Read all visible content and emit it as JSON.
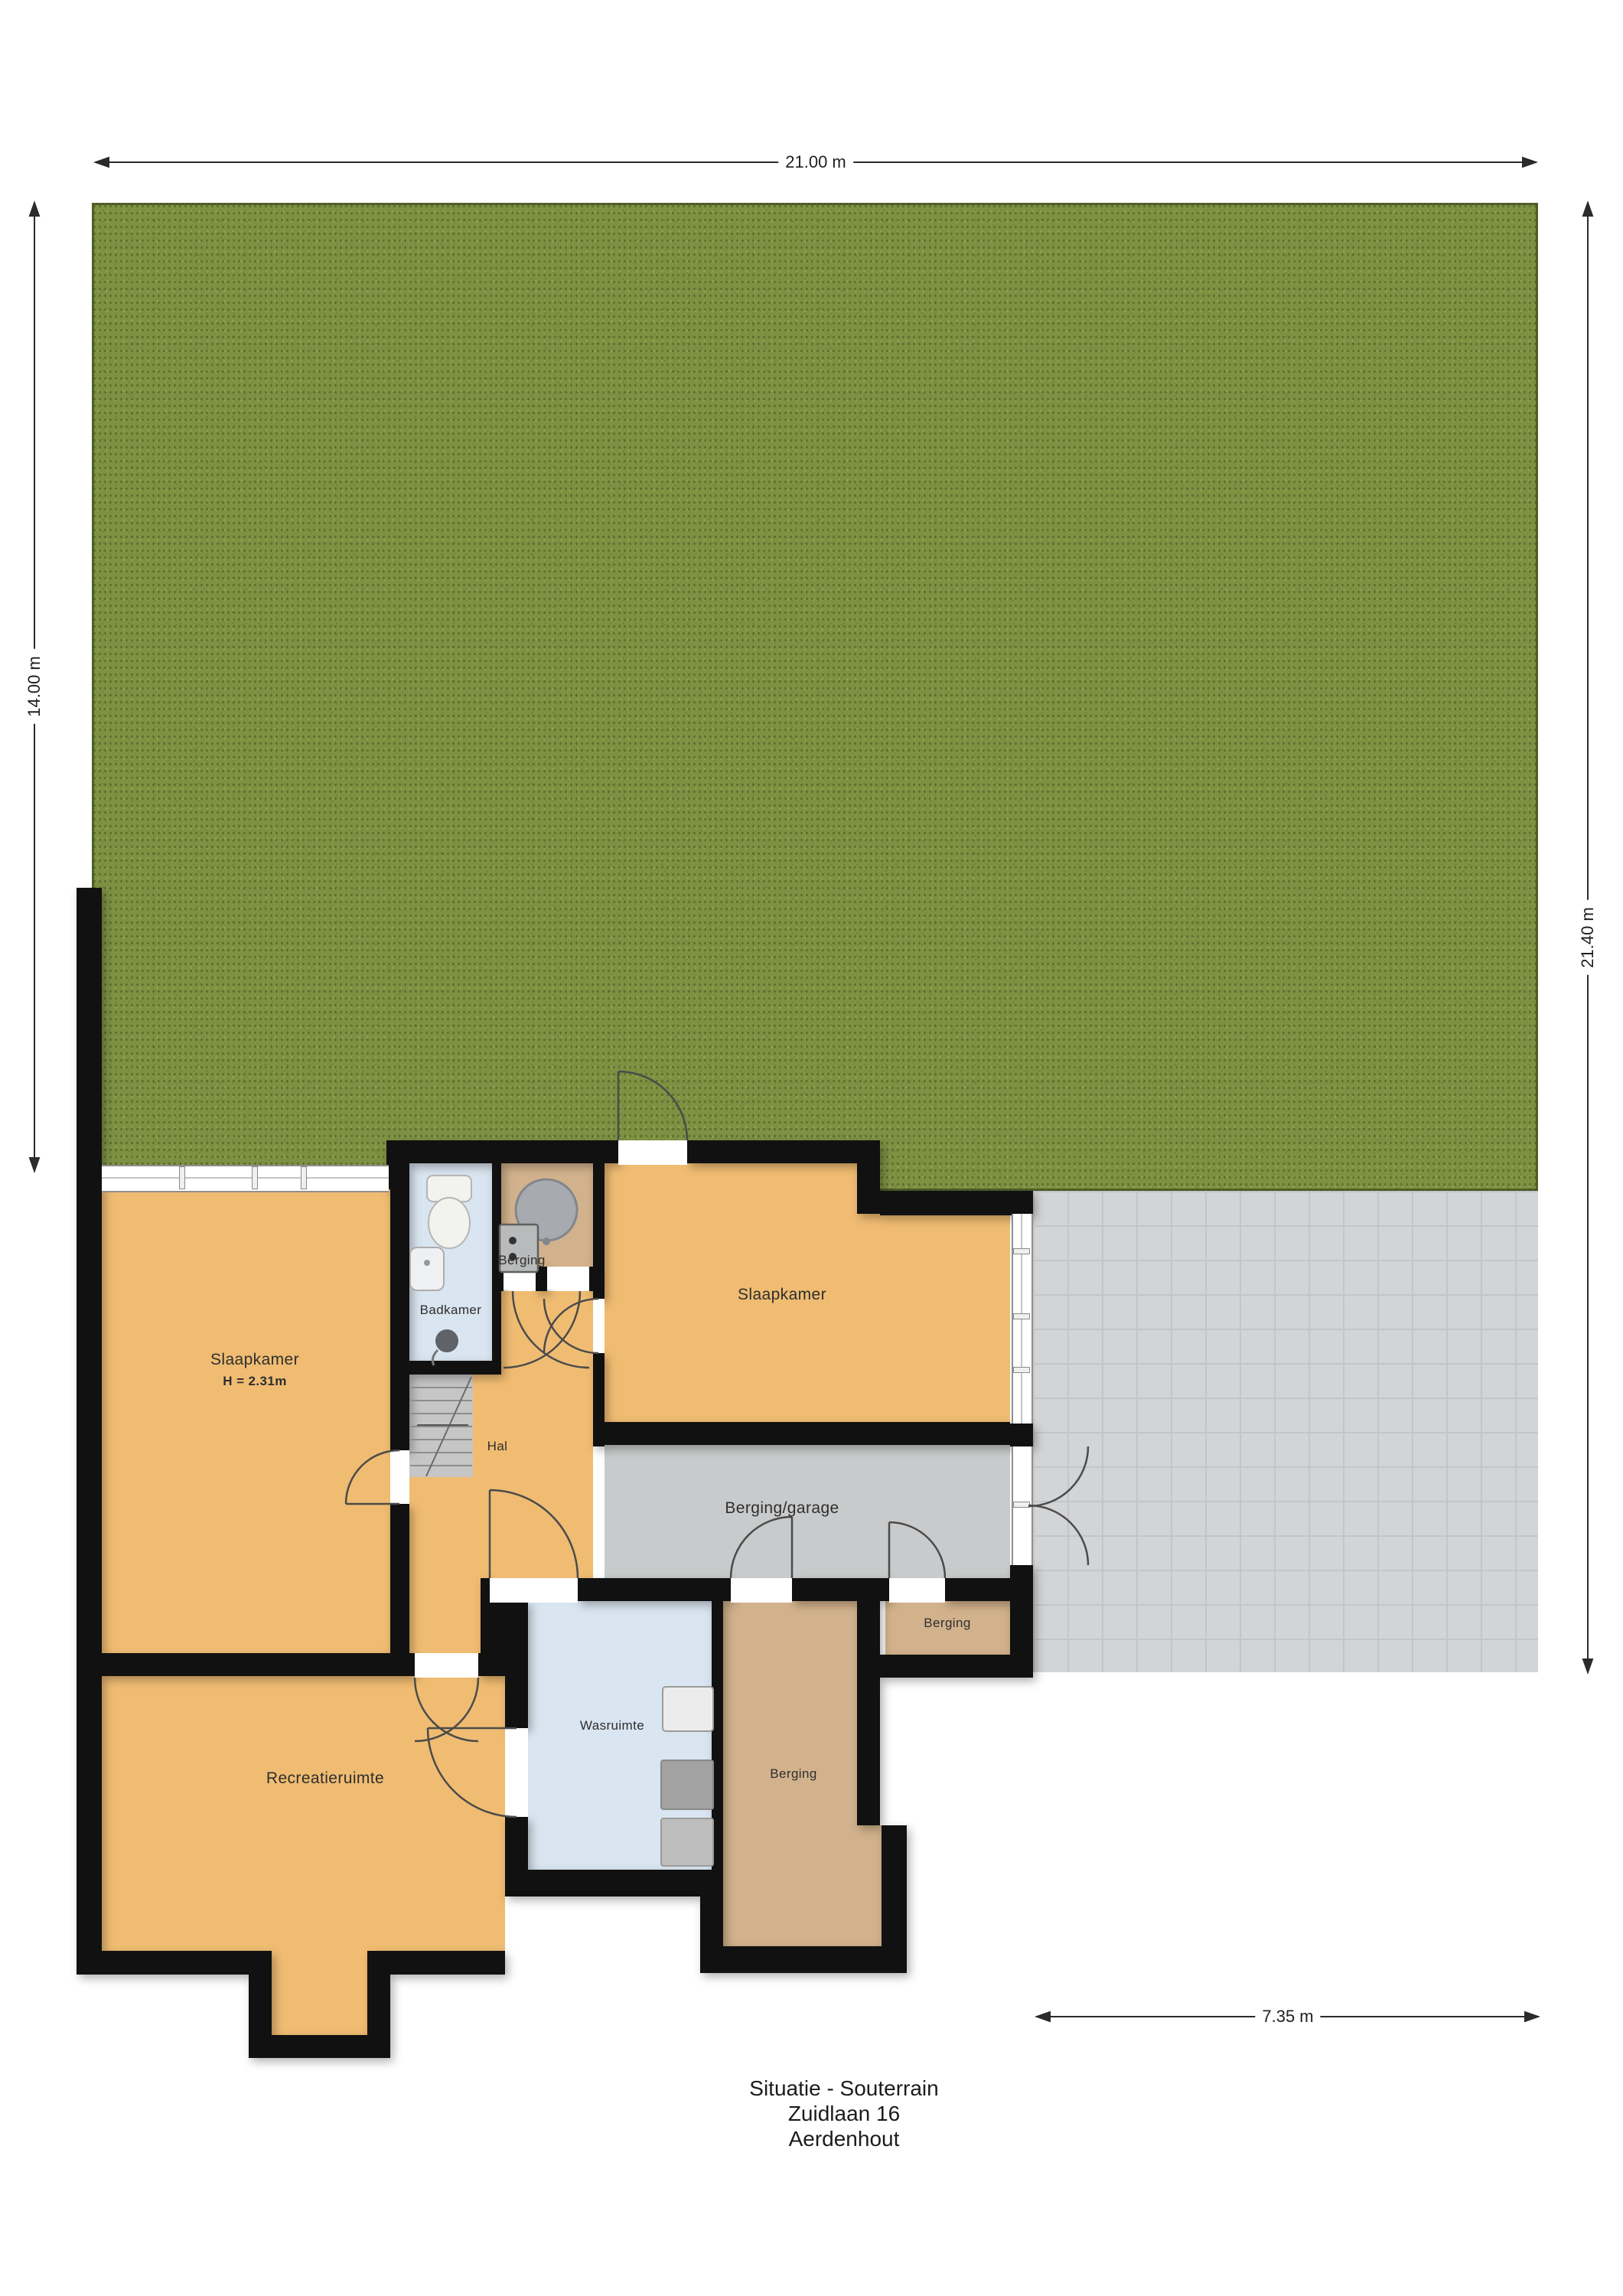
{
  "plan": {
    "type": "floor-plan",
    "floor": "Souterrain"
  },
  "title": {
    "line1": "Situatie - Souterrain",
    "line2": "Zuidlaan 16",
    "line3": "Aerdenhout"
  },
  "dimensions": {
    "top": "21.00 m",
    "left": "14.00 m",
    "right": "21.40 m",
    "bottom": "7.35 m"
  },
  "rooms": {
    "slaapkamer_left": {
      "label": "Slaapkamer",
      "height_note": "H = 2.31m"
    },
    "badkamer": {
      "label": "Badkamer"
    },
    "berging_top": {
      "label": "Berging"
    },
    "hal": {
      "label": "Hal"
    },
    "slaapkamer_right": {
      "label": "Slaapkamer"
    },
    "berging_garage": {
      "label": "Berging/garage"
    },
    "berging_right": {
      "label": "Berging"
    },
    "recreatieruimte": {
      "label": "Recreatieruimte"
    },
    "wasruimte": {
      "label": "Wasruimte"
    },
    "berging_bottom": {
      "label": "Berging"
    }
  },
  "colors": {
    "wall": "#111111",
    "room-orange": "#f0bc72",
    "room-tan": "#d2b28c",
    "room-gray": "#c9cacb",
    "room-blue": "#d9e5f0",
    "grass": "#7e9143",
    "terrace": "#d3d4d6",
    "terrace-line": "#c3c5c8",
    "label": "#2e2e2e"
  }
}
